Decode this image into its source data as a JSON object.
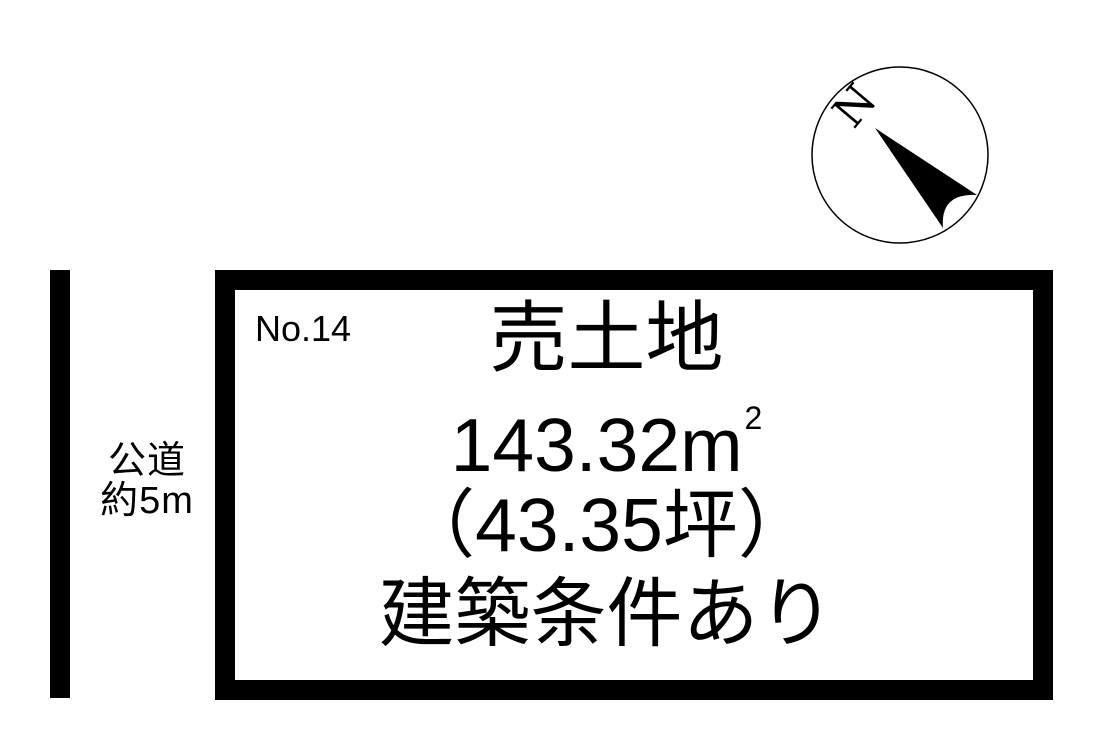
{
  "colors": {
    "ink": "#000000",
    "background": "#ffffff"
  },
  "compass": {
    "label": "N"
  },
  "road": {
    "name": "公道",
    "size": "約5m"
  },
  "plot": {
    "number": "No.14",
    "title": "売土地",
    "area_value": "143.32",
    "area_unit": "m",
    "area_exponent": "2",
    "tsubo": "（43.35坪）",
    "note": "建築条件あり"
  }
}
